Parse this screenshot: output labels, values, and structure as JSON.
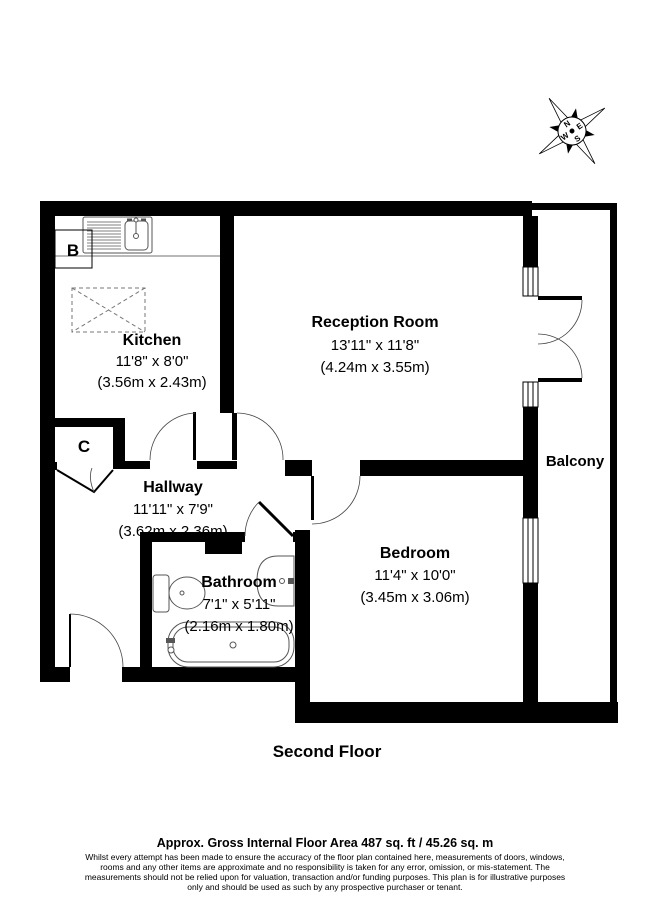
{
  "floor_title": "Second Floor",
  "rooms": {
    "kitchen": {
      "name": "Kitchen",
      "imperial": "11'8\" x 8'0\"",
      "metric": "(3.56m x 2.43m)"
    },
    "reception": {
      "name": "Reception Room",
      "imperial": "13'11\" x 11'8\"",
      "metric": "(4.24m x 3.55m)"
    },
    "hallway": {
      "name": "Hallway",
      "imperial": "11'11\" x 7'9\"",
      "metric": "(3.62m x 2.36m)"
    },
    "bathroom": {
      "name": "Bathroom",
      "imperial": "7'1\" x 5'11\"",
      "metric": "(2.16m x 1.80m)"
    },
    "bedroom": {
      "name": "Bedroom",
      "imperial": "11'4\" x 10'0\"",
      "metric": "(3.45m x 3.06m)"
    },
    "balcony": {
      "name": "Balcony"
    }
  },
  "annotations": {
    "boiler": "B",
    "cupboard": "C"
  },
  "compass": {
    "north": "N",
    "east": "E",
    "south": "S",
    "west": "W"
  },
  "footer": {
    "area_line": "Approx. Gross Internal Floor Area 487 sq. ft / 45.26 sq. m",
    "disclaimer": [
      "Whilst every attempt has been made to ensure the accuracy of the floor plan contained here, measurements of doors, windows,",
      "rooms and any other items are approximate and no responsibility is taken for any error, omission, or mis-statement. The",
      "measurements should not be relied upon for valuation, transaction and/or funding purposes. This plan is for illustrative purposes",
      "only and should be used as such by any prospective purchaser or tenant."
    ]
  },
  "colors": {
    "wall": "#000000",
    "background": "#ffffff"
  }
}
